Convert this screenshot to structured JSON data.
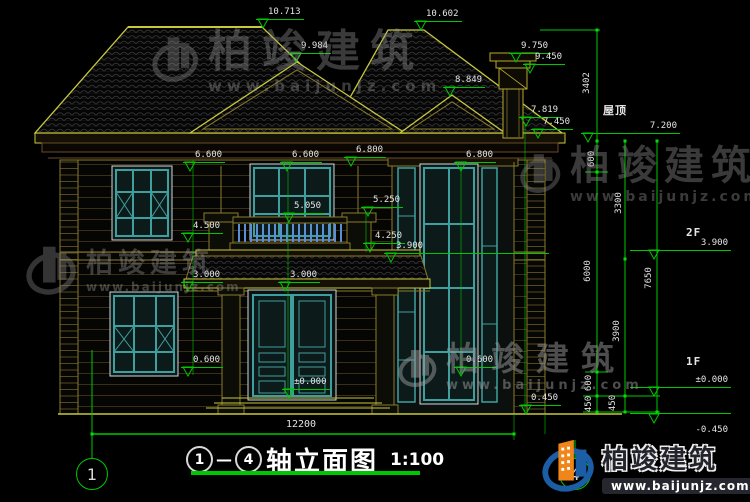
{
  "watermark": {
    "brand": "柏竣建筑",
    "url": "www.baijunjz.com"
  },
  "brand": {
    "name": "柏竣建筑",
    "url": "www.baijunjz.com"
  },
  "title": {
    "bubble_start": "1",
    "separator": "—",
    "bubble_end": "4",
    "text": "轴立面图",
    "scale": "1:100"
  },
  "axes": {
    "left": "1",
    "right": "4"
  },
  "labels": {
    "roof": "屋顶",
    "second_floor": "2F",
    "first_floor": "1F"
  },
  "elevations": {
    "e10713": "10.713",
    "e10602": "10.602",
    "e9984": "9.984",
    "e8849": "8.849",
    "e9750": "9.750",
    "e9450": "9.450",
    "e7819": "7.819",
    "e7450": "7.450",
    "e7200": "7.200",
    "e6600": "6.600",
    "e6800": "6.800",
    "e5250": "5.250",
    "e5050": "5.050",
    "e4500": "4.500",
    "e4250": "4.250",
    "e3900": "3.900",
    "e3000": "3.000",
    "e0600": "0.600",
    "e0000": "±0.000",
    "e0450": "0.450",
    "em0450": "-0.450"
  },
  "vertical_dims": {
    "d3402": "3402",
    "d600": "600",
    "d6000": "6000",
    "d3300": "3300",
    "d3900": "3900",
    "d7650": "7650",
    "d450": "450"
  },
  "horizontal_dims": {
    "total": "12200"
  },
  "colors": {
    "dim_green": "#00c800",
    "line_yellow": "#c8c83c",
    "frame_teal": "#3f9f9f",
    "baluster_blue": "#5b8fd4",
    "logo_blue": "#1b5ea6",
    "logo_orange": "#f08519"
  }
}
